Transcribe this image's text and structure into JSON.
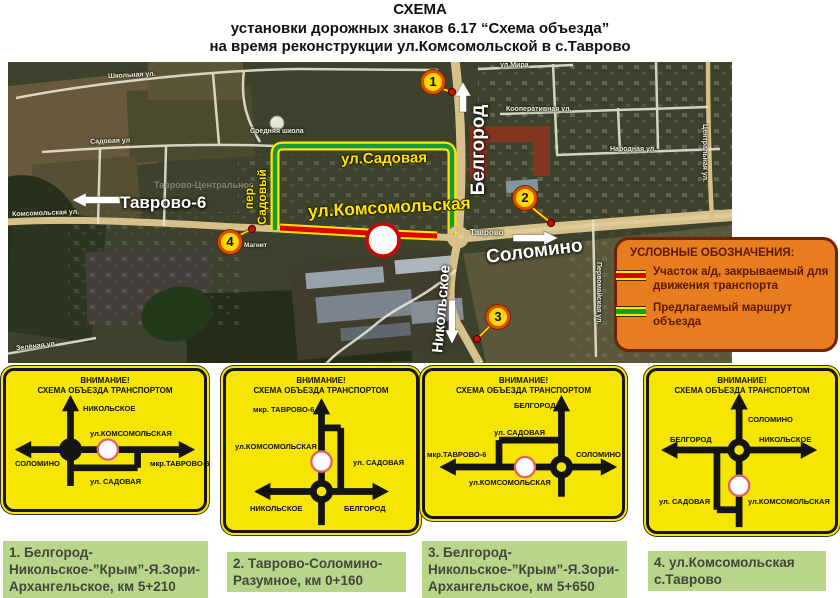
{
  "title": {
    "line1": "СХЕМА",
    "line2": "установки дорожных знаков 6.17 “Схема объезда”",
    "line3": "на время реконструкции ул.Комсомольской в с.Таврово"
  },
  "map": {
    "labels": {
      "shkolnaya": "Школьная ул.",
      "sadovaya_ul": "Садовая ул",
      "srednyaya_shkola": "Средняя школа",
      "tavrovo_centralnoe": "Таврово-Центральное",
      "komsomolskaya_ul": "Комсомольская ул.",
      "zelenaya": "Зелёная ул",
      "ul_mira": "ул.Мира",
      "kooperativnaya": "Кооперативная ул.",
      "narodnaya": "Народная ул.",
      "centralnaya": "Центральная ул.",
      "pervomayskaya": "Первомайская ул.",
      "magnit": "Магнит",
      "tavrovo": "Таврово"
    },
    "big_labels": {
      "tavrovo6": "Таврово-6",
      "belgorod": "Белгород",
      "solomino": "Соломино",
      "nikolskoe": "Никольское"
    },
    "route_labels": {
      "sadovaya": "ул.Садовая",
      "komsomolskaya": "ул.Комсомольская",
      "per": "пер.",
      "sadoviy": "Садовый"
    },
    "markers": [
      {
        "n": "1"
      },
      {
        "n": "2"
      },
      {
        "n": "3"
      },
      {
        "n": "4"
      }
    ]
  },
  "legend": {
    "title": "УСЛОВНЫЕ ОБОЗНАЧЕНИЯ:",
    "item1": "Участок а/д, закрываемый для движения транспорта",
    "item2": "Предлагаемый маршрут объезда",
    "closed_color": "#d90000",
    "detour_color": "#119a3a",
    "edge_color": "#ffe400"
  },
  "signs": [
    {
      "header1": "ВНИМАНИЕ!",
      "header2": "СХЕМА ОБЪЕЗДА ТРАНСПОРТОМ",
      "nikolskoe": "НИКОЛЬСКОЕ",
      "komsomolskaya": "ул.КОМСОМОЛЬСКАЯ",
      "solomino": "СОЛОМИНО",
      "tavrovo6": "мкр.ТАВРОВО-6",
      "sadovaya": "ул. САДОВАЯ"
    },
    {
      "header1": "ВНИМАНИЕ!",
      "header2": "СХЕМА ОБЪЕЗДА ТРАНСПОРТОМ",
      "tavrovo6": "мкр. ТАВРОВО-6",
      "komsomolskaya": "ул.КОМСОМОЛЬСКАЯ",
      "sadovaya": "ул. САДОВАЯ",
      "nikolskoe": "НИКОЛЬСКОЕ",
      "belgorod": "БЕЛГОРОД"
    },
    {
      "header1": "ВНИМАНИЕ!",
      "header2": "СХЕМА ОБЪЕЗДА ТРАНСПОРТОМ",
      "belgorod": "БЕЛГОРОД",
      "sadovaya": "ул. САДОВАЯ",
      "tavrovo6": "мкр.ТАВРОВО-6",
      "solomino": "СОЛОМИНО",
      "komsomolskaya": "ул.КОМСОМОЛЬСКАЯ"
    },
    {
      "header1": "ВНИМАНИЕ!",
      "header2": "СХЕМА ОБЪЕЗДА ТРАНСПОРТОМ",
      "solomino": "СОЛОМИНО",
      "belgorod": "БЕЛГОРОД",
      "nikolskoe": "НИКОЛЬСКОЕ",
      "sadovaya": "ул. САДОВАЯ",
      "komsomolskaya": "ул.КОМСОМОЛЬСКАЯ"
    }
  ],
  "captions": [
    {
      "text": "1. Белгород-Никольское-”Крым”-Я.Зори-Архангельское, км 5+210"
    },
    {
      "text": "2. Таврово-Соломино-Разумное, км 0+160"
    },
    {
      "text": "3. Белгород-Никольское-”Крым”-Я.Зори-Архангельское, км 5+650"
    },
    {
      "text": "4. ул.Комсомольская с.Таврово"
    }
  ]
}
